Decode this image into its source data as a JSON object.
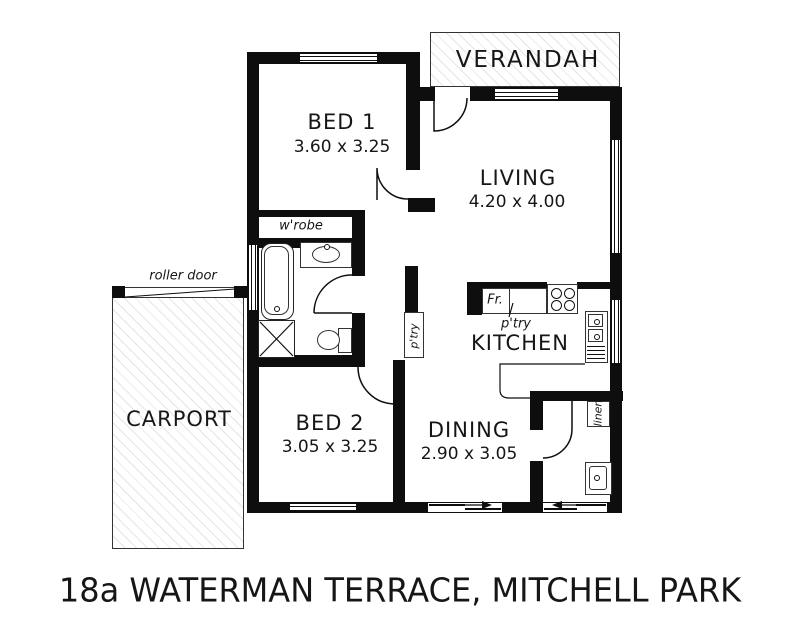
{
  "title": "18a WATERMAN TERRACE, MITCHELL PARK",
  "rooms": {
    "bed1": {
      "name": "BED 1",
      "dims": "3.60 x 3.25"
    },
    "living": {
      "name": "LIVING",
      "dims": "4.20 x 4.00"
    },
    "bed2": {
      "name": "BED 2",
      "dims": "3.05 x 3.25"
    },
    "dining": {
      "name": "DINING",
      "dims": "2.90 x 3.05"
    },
    "kitchen": {
      "name": "KITCHEN"
    },
    "carport": {
      "name": "CARPORT"
    },
    "verandah": {
      "name": "VERANDAH"
    }
  },
  "labels": {
    "wardrobe": "w'robe",
    "roller_door": "roller door",
    "pantry_hall": "p'try",
    "pantry_kitchen": "p'try",
    "fridge": "Fr.",
    "linen": "linen"
  },
  "colors": {
    "wall": "#0e0e0e",
    "background": "#ffffff",
    "text": "#161616",
    "hatch": "#d9d9d9"
  }
}
